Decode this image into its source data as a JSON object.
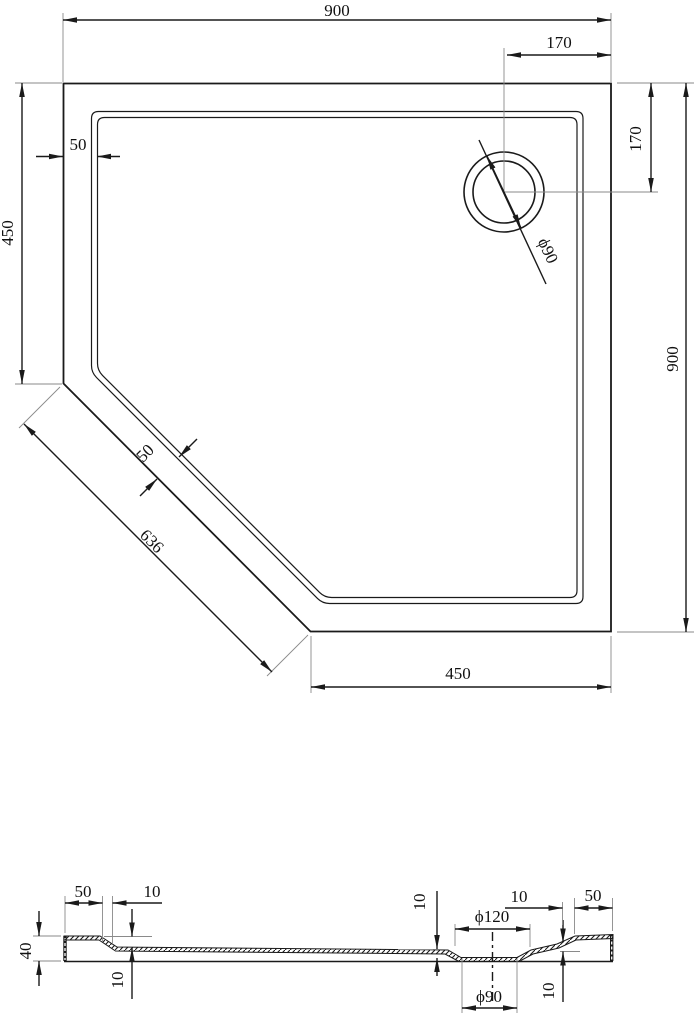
{
  "plan_view": {
    "width_top": "900",
    "drain_offset_horizontal": "170",
    "drain_offset_vertical": "170",
    "height_right": "900",
    "left_edge_length": "450",
    "bottom_edge_length": "450",
    "rim_width_top": "50",
    "rim_width_diagonal": "50",
    "diagonal_edge_length": "636",
    "drain_diameter": "ϕ90"
  },
  "section_view": {
    "rim_width_left": "50",
    "slope_width_left": "10",
    "overall_height": "40",
    "rim_depth_left": "10",
    "recess_depth": "10",
    "recess_diameter": "ϕ120",
    "drain_hole_diameter": "ϕ90",
    "rise_height_right": "10",
    "slope_width_right": "10",
    "rim_width_right": "50"
  },
  "colors": {
    "line": "#1a1a1a",
    "extension_line": "#8a8a8a",
    "background": "#ffffff"
  }
}
